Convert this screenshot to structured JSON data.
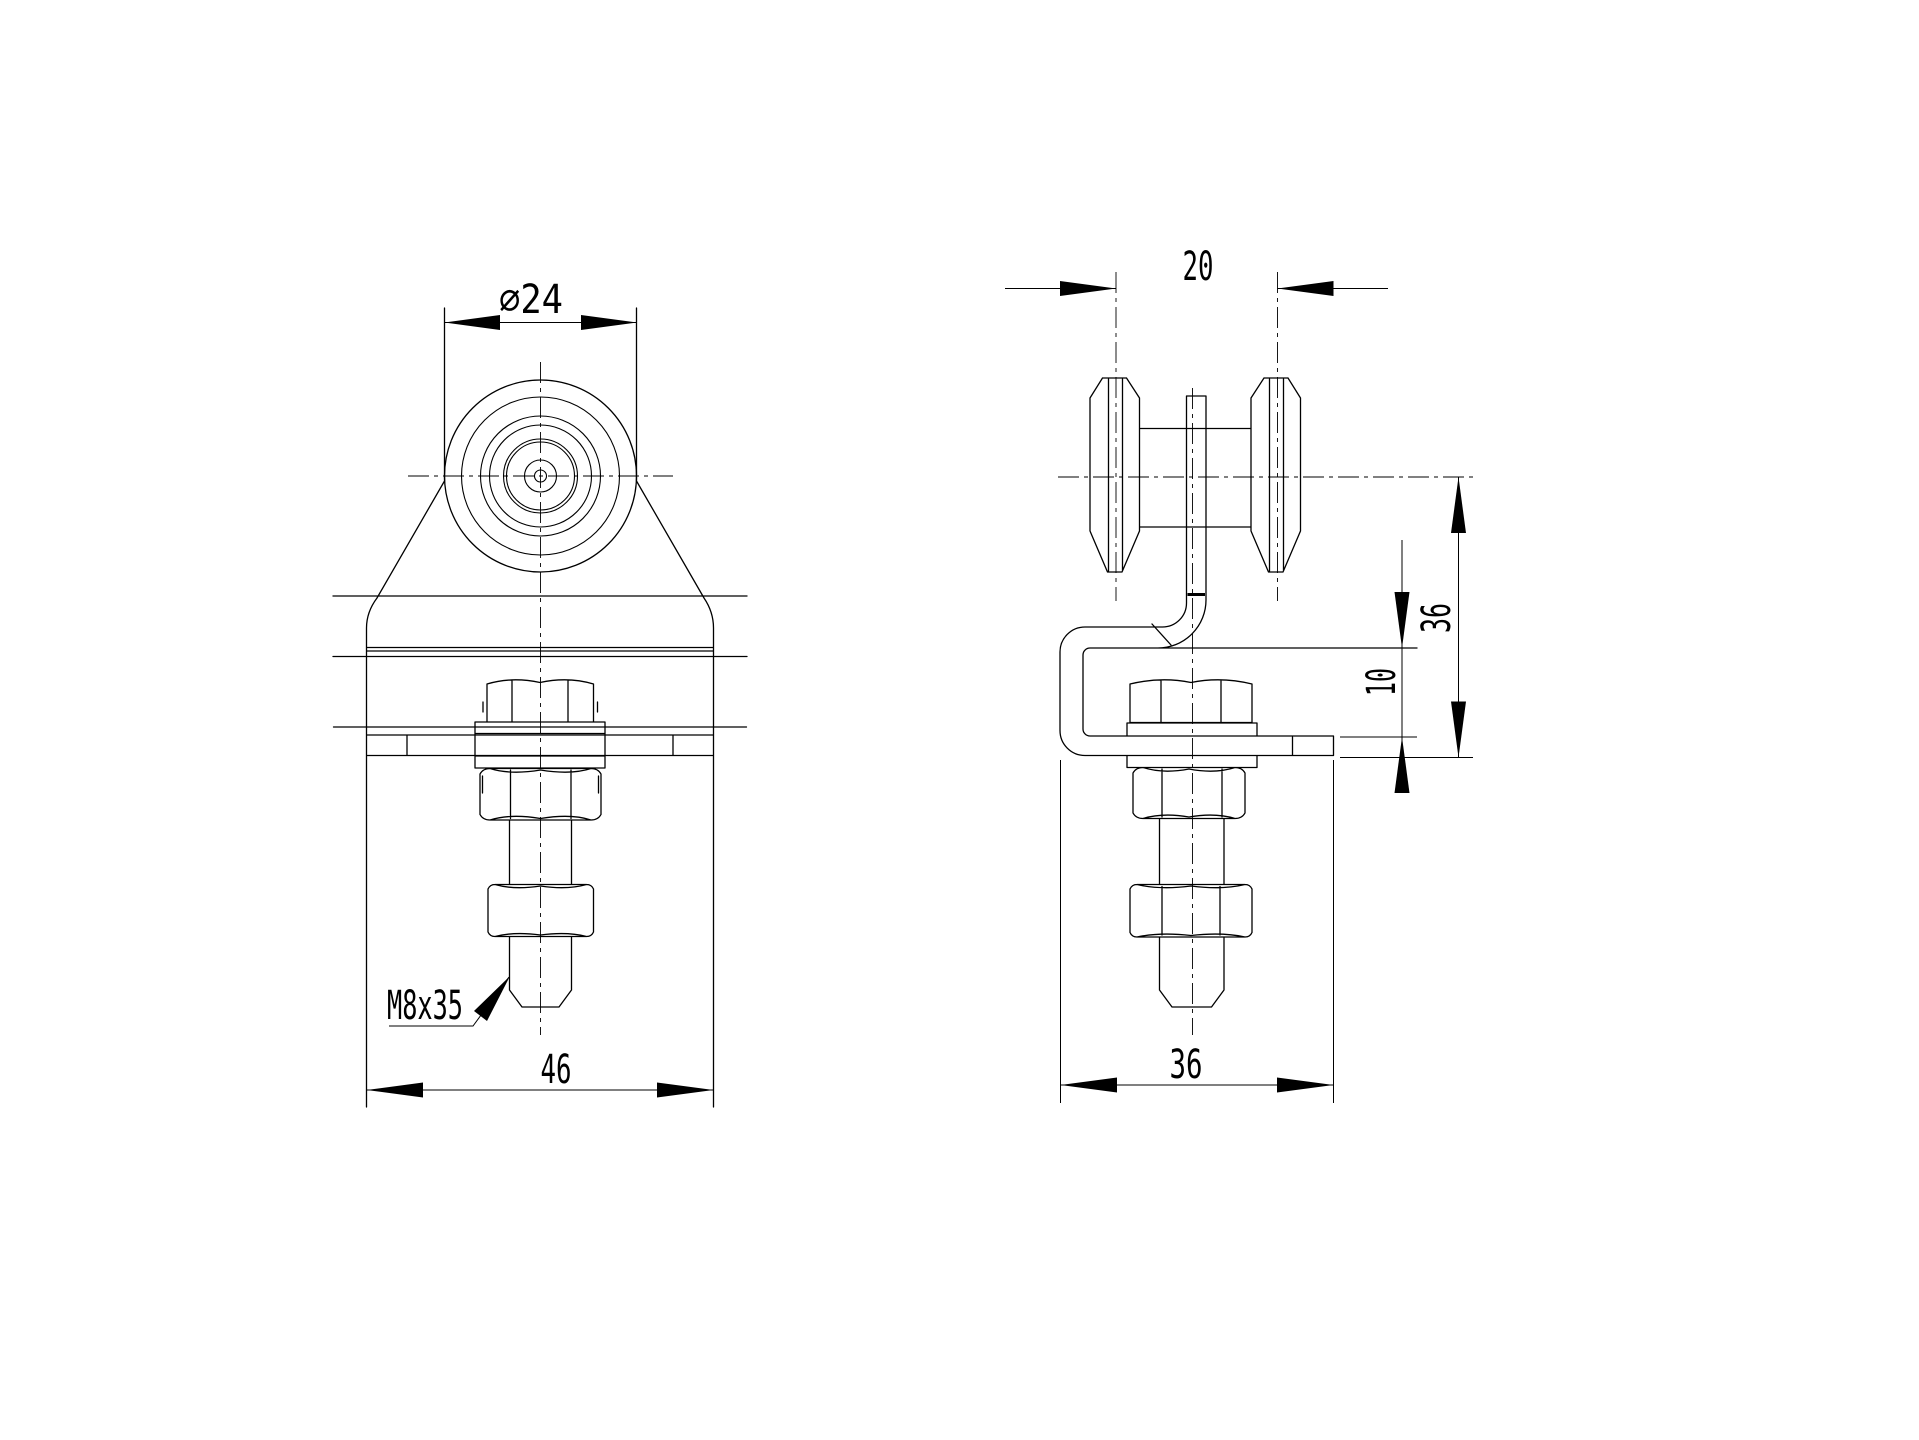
{
  "sheet": {
    "background": "#ffffff",
    "line_color": "#000000"
  },
  "drawing": {
    "kind": "technical-drawing",
    "dims": {
      "front": {
        "diameter": "⌀24",
        "width": "46",
        "thread_callout": "M8x35"
      },
      "side": {
        "roller_width": "20",
        "height": "36",
        "bracket_offset": "10",
        "width": "36"
      }
    }
  }
}
